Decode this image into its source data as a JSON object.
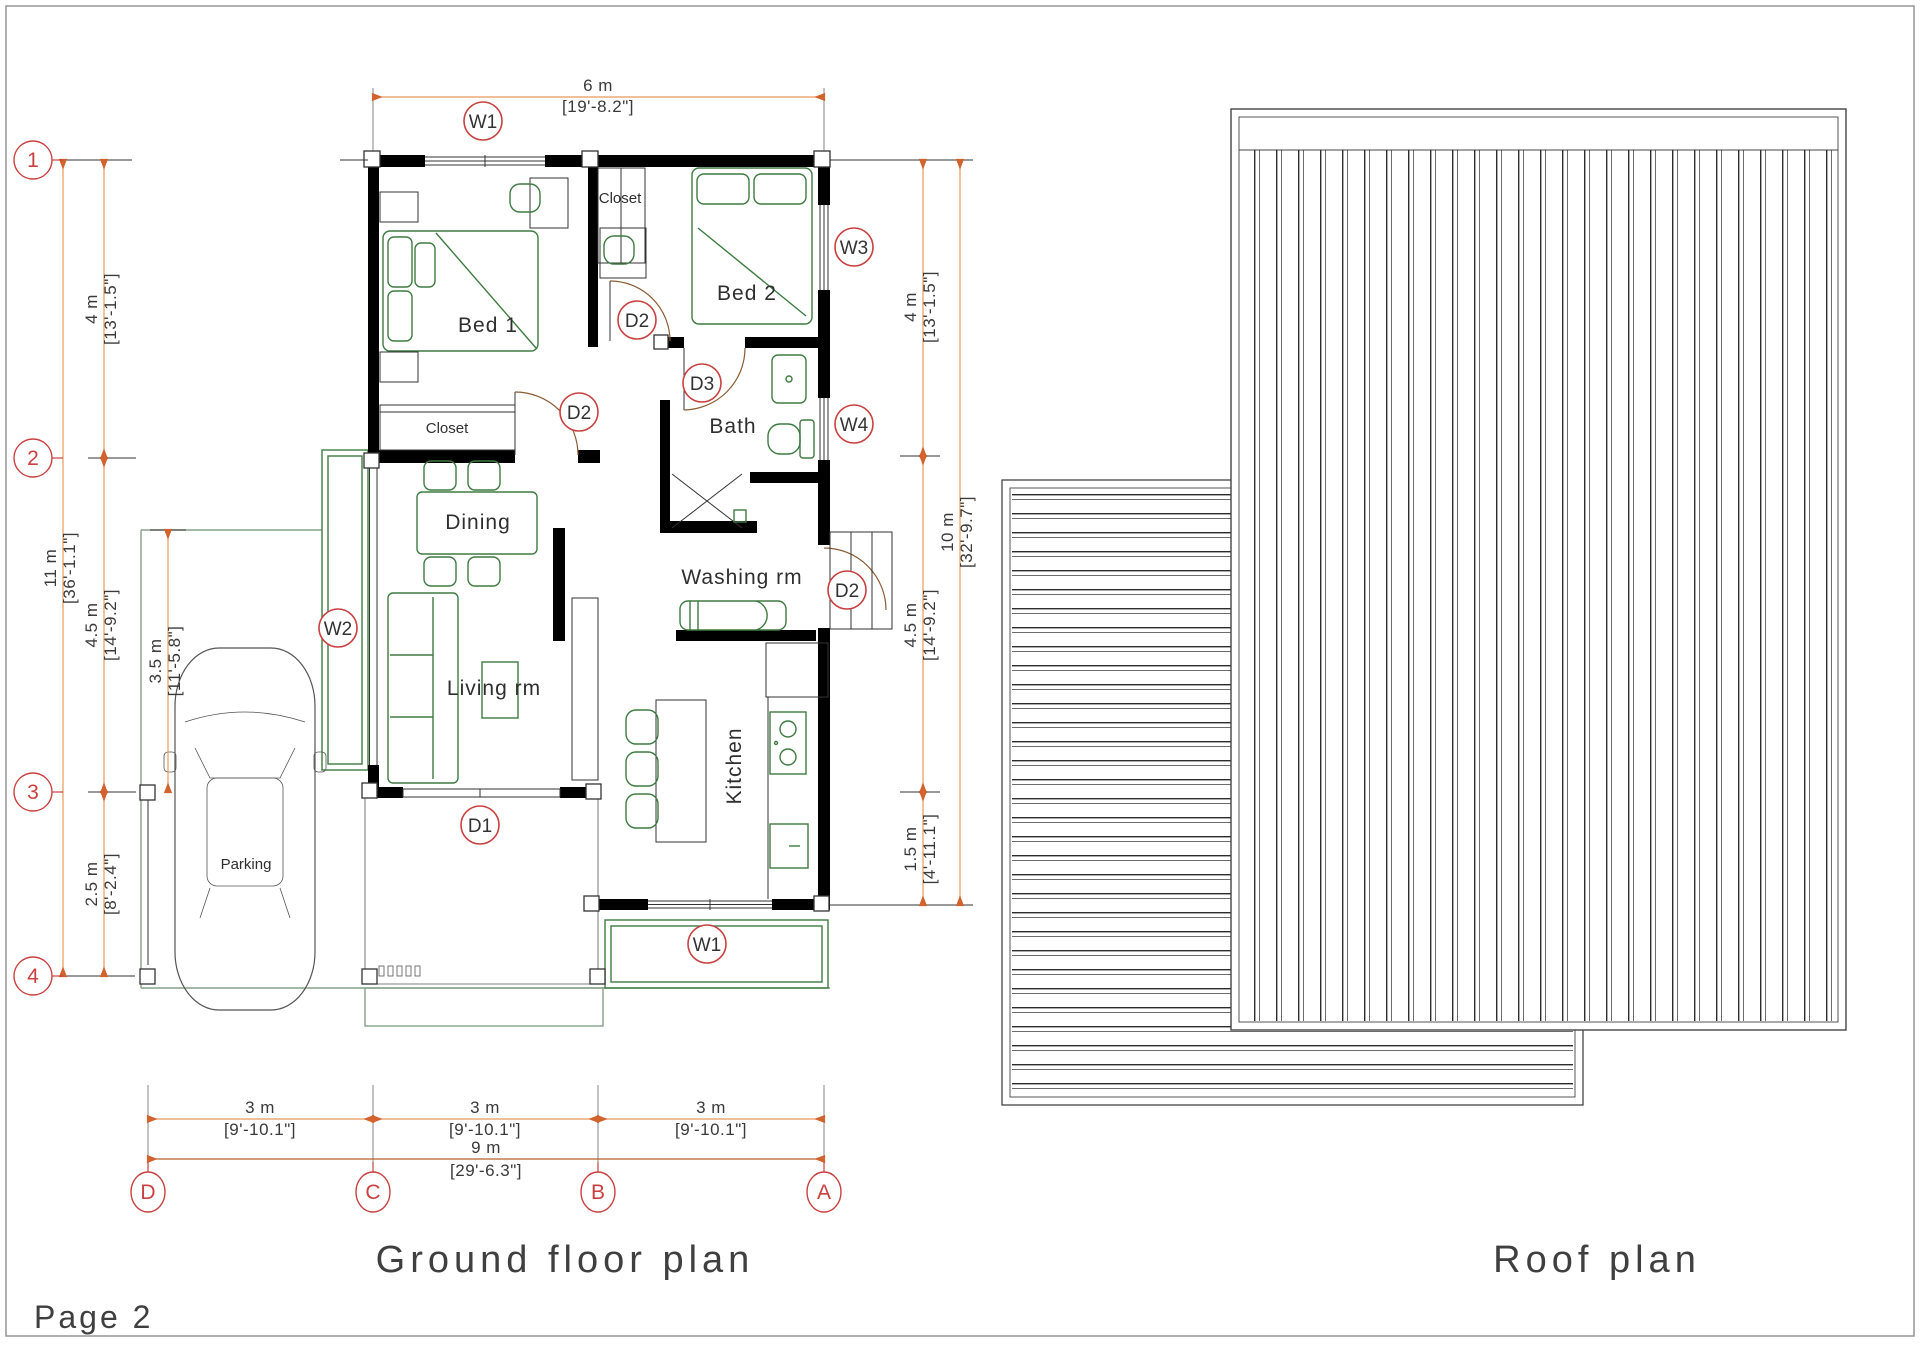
{
  "page": {
    "label": "Page 2"
  },
  "titles": {
    "ground_floor": "Ground floor plan",
    "roof": "Roof plan"
  },
  "grid": {
    "rows": [
      "1",
      "2",
      "3",
      "4"
    ],
    "cols": [
      "D",
      "C",
      "B",
      "A"
    ]
  },
  "tags": {
    "w1": "W1",
    "w2": "W2",
    "w3": "W3",
    "w4": "W4",
    "d1": "D1",
    "d2": "D2",
    "d3": "D3"
  },
  "rooms": {
    "bed1": "Bed 1",
    "bed2": "Bed 2",
    "closet": "Closet",
    "bath": "Bath",
    "dining": "Dining",
    "living": "Living rm",
    "washing": "Washing rm",
    "kitchen": "Kitchen",
    "parking": "Parking"
  },
  "dims": {
    "top": {
      "m": "6 m",
      "ft": "[19'-8.2\"]"
    },
    "left": [
      {
        "m": "4 m",
        "ft": "[13'-1.5\"]"
      },
      {
        "m": "11 m",
        "ft": "[36'-1.1\"]"
      },
      {
        "m": "4.5 m",
        "ft": "[14'-9.2\"]"
      },
      {
        "m": "3.5 m",
        "ft": "[11'-5.8\"]"
      },
      {
        "m": "2.5 m",
        "ft": "[8'-2.4\"]"
      }
    ],
    "right": [
      {
        "m": "4 m",
        "ft": "[13'-1.5\"]"
      },
      {
        "m": "10 m",
        "ft": "[32'-9.7\"]"
      },
      {
        "m": "4.5 m",
        "ft": "[14'-9.2\"]"
      },
      {
        "m": "1.5 m",
        "ft": "[4'-11.1\"]"
      }
    ],
    "bottom": [
      {
        "m": "3 m",
        "ft": "[9'-10.1\"]"
      },
      {
        "m": "3 m",
        "ft": "[9'-10.1\"]"
      },
      {
        "m": "3 m",
        "ft": "[9'-10.1\"]"
      },
      {
        "m": "9 m",
        "ft": "[29'-6.3\"]"
      }
    ]
  },
  "colors": {
    "dimension_line": "#e8995c",
    "dimension_arrow": "#d2622e",
    "tag_red": "#c94040",
    "furniture_green": "#3e7b41",
    "site_green": "#86a188",
    "wall_black": "#000000",
    "door_arc_brown": "#8a5c34"
  }
}
